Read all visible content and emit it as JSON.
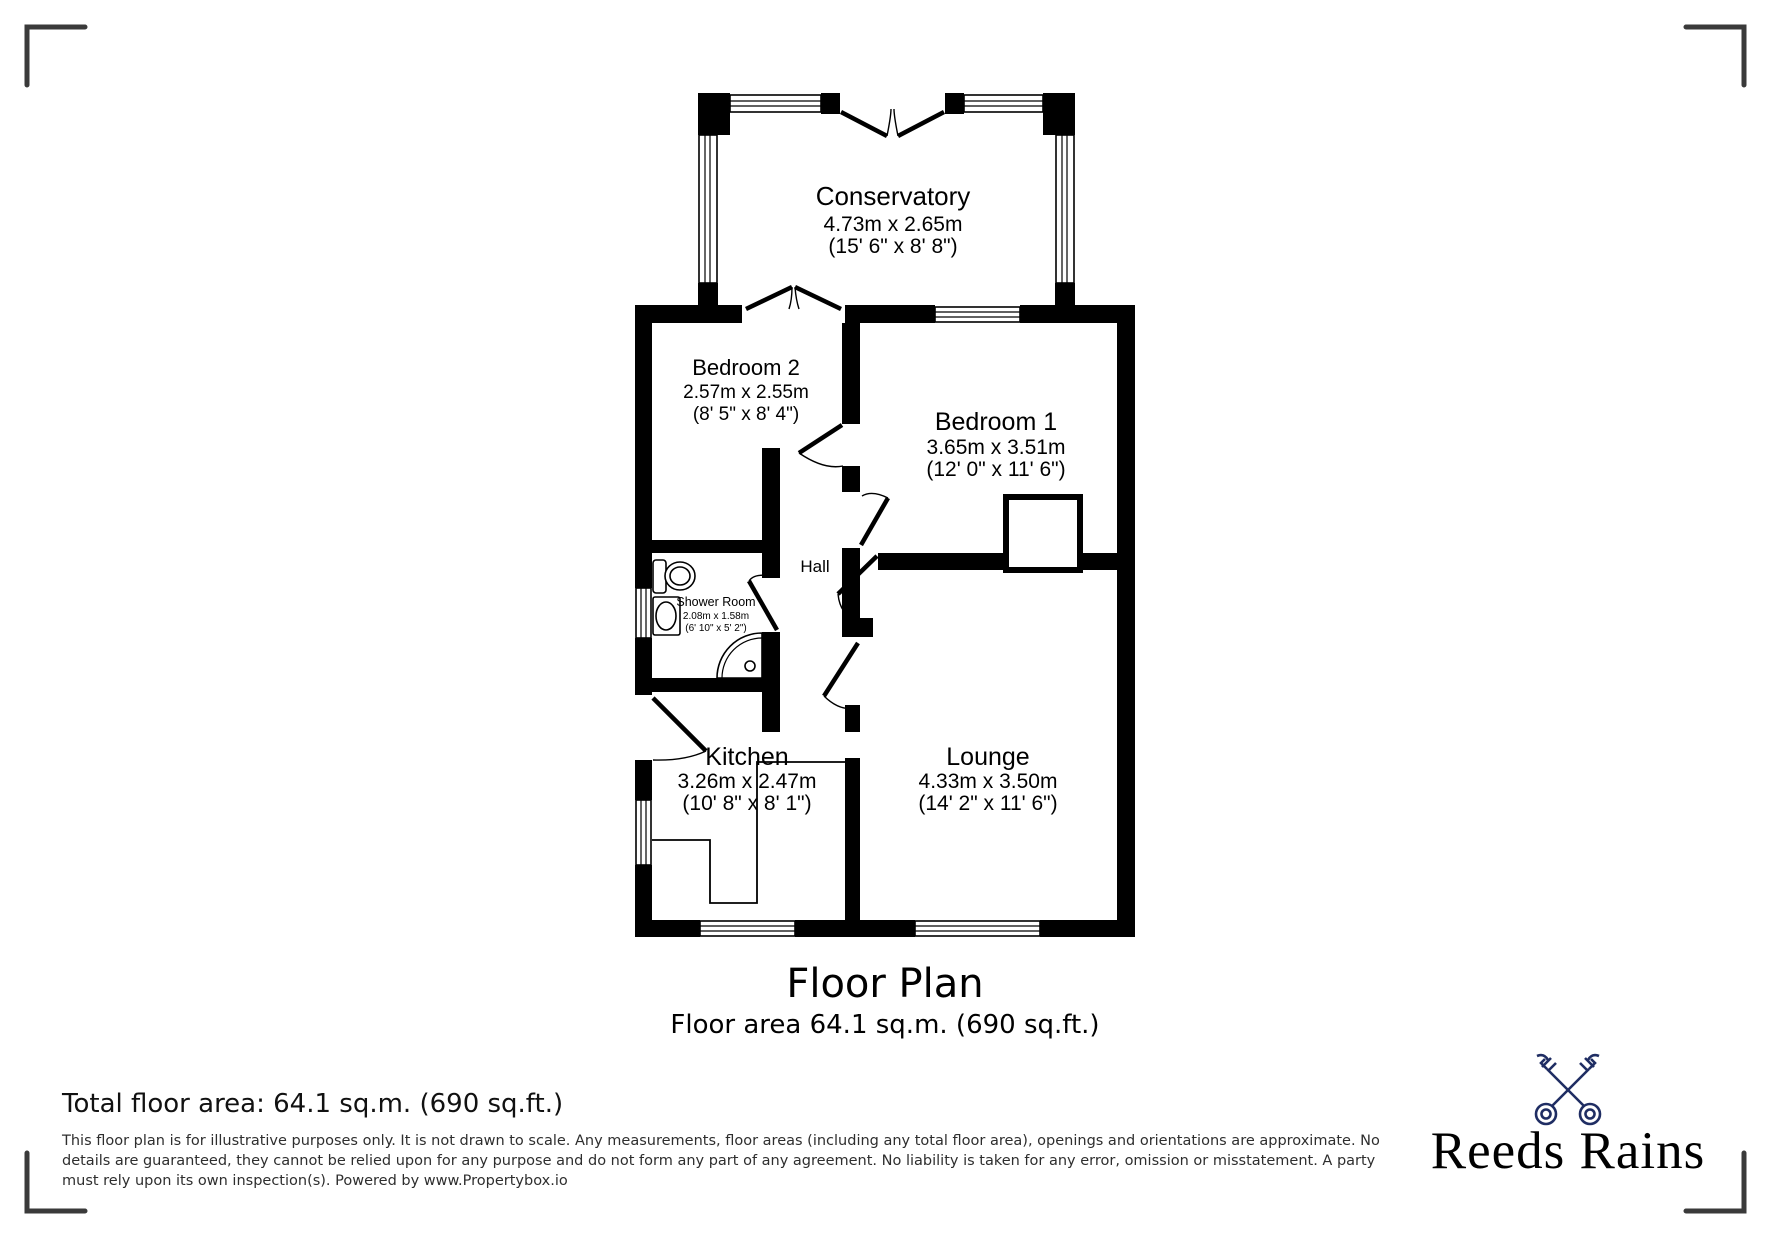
{
  "plan": {
    "title": "Floor Plan",
    "subtitle": "Floor area 64.1 sq.m. (690 sq.ft.)",
    "rooms": {
      "conservatory": {
        "name": "Conservatory",
        "metric": "4.73m x 2.65m",
        "imperial": "(15' 6\" x 8' 8\")"
      },
      "bedroom2": {
        "name": "Bedroom 2",
        "metric": "2.57m x 2.55m",
        "imperial": "(8' 5\" x 8' 4\")"
      },
      "bedroom1": {
        "name": "Bedroom 1",
        "metric": "3.65m x 3.51m",
        "imperial": "(12' 0\" x 11' 6\")"
      },
      "shower": {
        "name": "Shower Room",
        "metric": "2.08m x 1.58m",
        "imperial": "(6' 10\" x 5' 2\")"
      },
      "hall": {
        "name": "Hall"
      },
      "kitchen": {
        "name": "Kitchen",
        "metric": "3.26m x 2.47m",
        "imperial": "(10' 8\" x 8' 1\")"
      },
      "lounge": {
        "name": "Lounge",
        "metric": "4.33m x 3.50m",
        "imperial": "(14' 2\" x 11' 6\")"
      }
    }
  },
  "footer": {
    "total_area": "Total floor area: 64.1 sq.m. (690 sq.ft.)",
    "disclaimer_lines": [
      "This floor plan is for illustrative purposes only. It is not drawn to scale. Any measurements, floor areas (including any total floor area), openings and orientations are approximate. No",
      "details are guaranteed, they cannot be relied upon for any purpose and do not form any part of any agreement. No liability is taken for any error, omission or misstatement. A party",
      "must rely upon its own inspection(s). Powered by www.Propertybox.io"
    ],
    "brand": {
      "name": "Reeds Rains",
      "color": "#1f2d63",
      "icon": "crossed-keys"
    }
  }
}
